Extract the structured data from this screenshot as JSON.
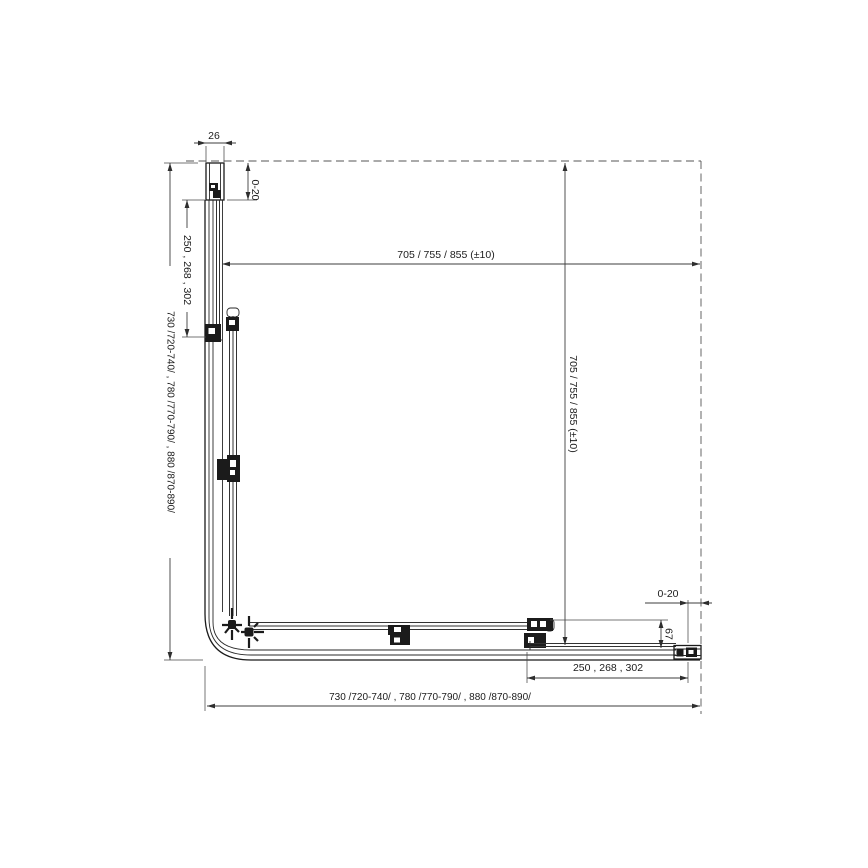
{
  "drawing": {
    "type": "corner-shower-enclosure-top-view-technical-drawing",
    "background_color": "#ffffff",
    "line_color": "#1b1b1b",
    "dimension_color": "#3d3d3d",
    "dimensions": {
      "top_profile_width": "26",
      "top_wall_gap": "0-20",
      "left_fixed_panel": "250 , 268 , 302",
      "left_overall": "730 /720-740/ , 780 /770-790/ , 880 /870-890/",
      "top_opening": "705 / 755 / 855  (±10)",
      "right_opening": "705 / 755 / 855  (±10)",
      "right_wall_gap": "0-20",
      "profile_depth": "67",
      "bottom_fixed_panel": "250 , 268 , 302",
      "bottom_overall": "730 /720-740/ , 780 /770-790/ , 880 /870-890/"
    }
  }
}
